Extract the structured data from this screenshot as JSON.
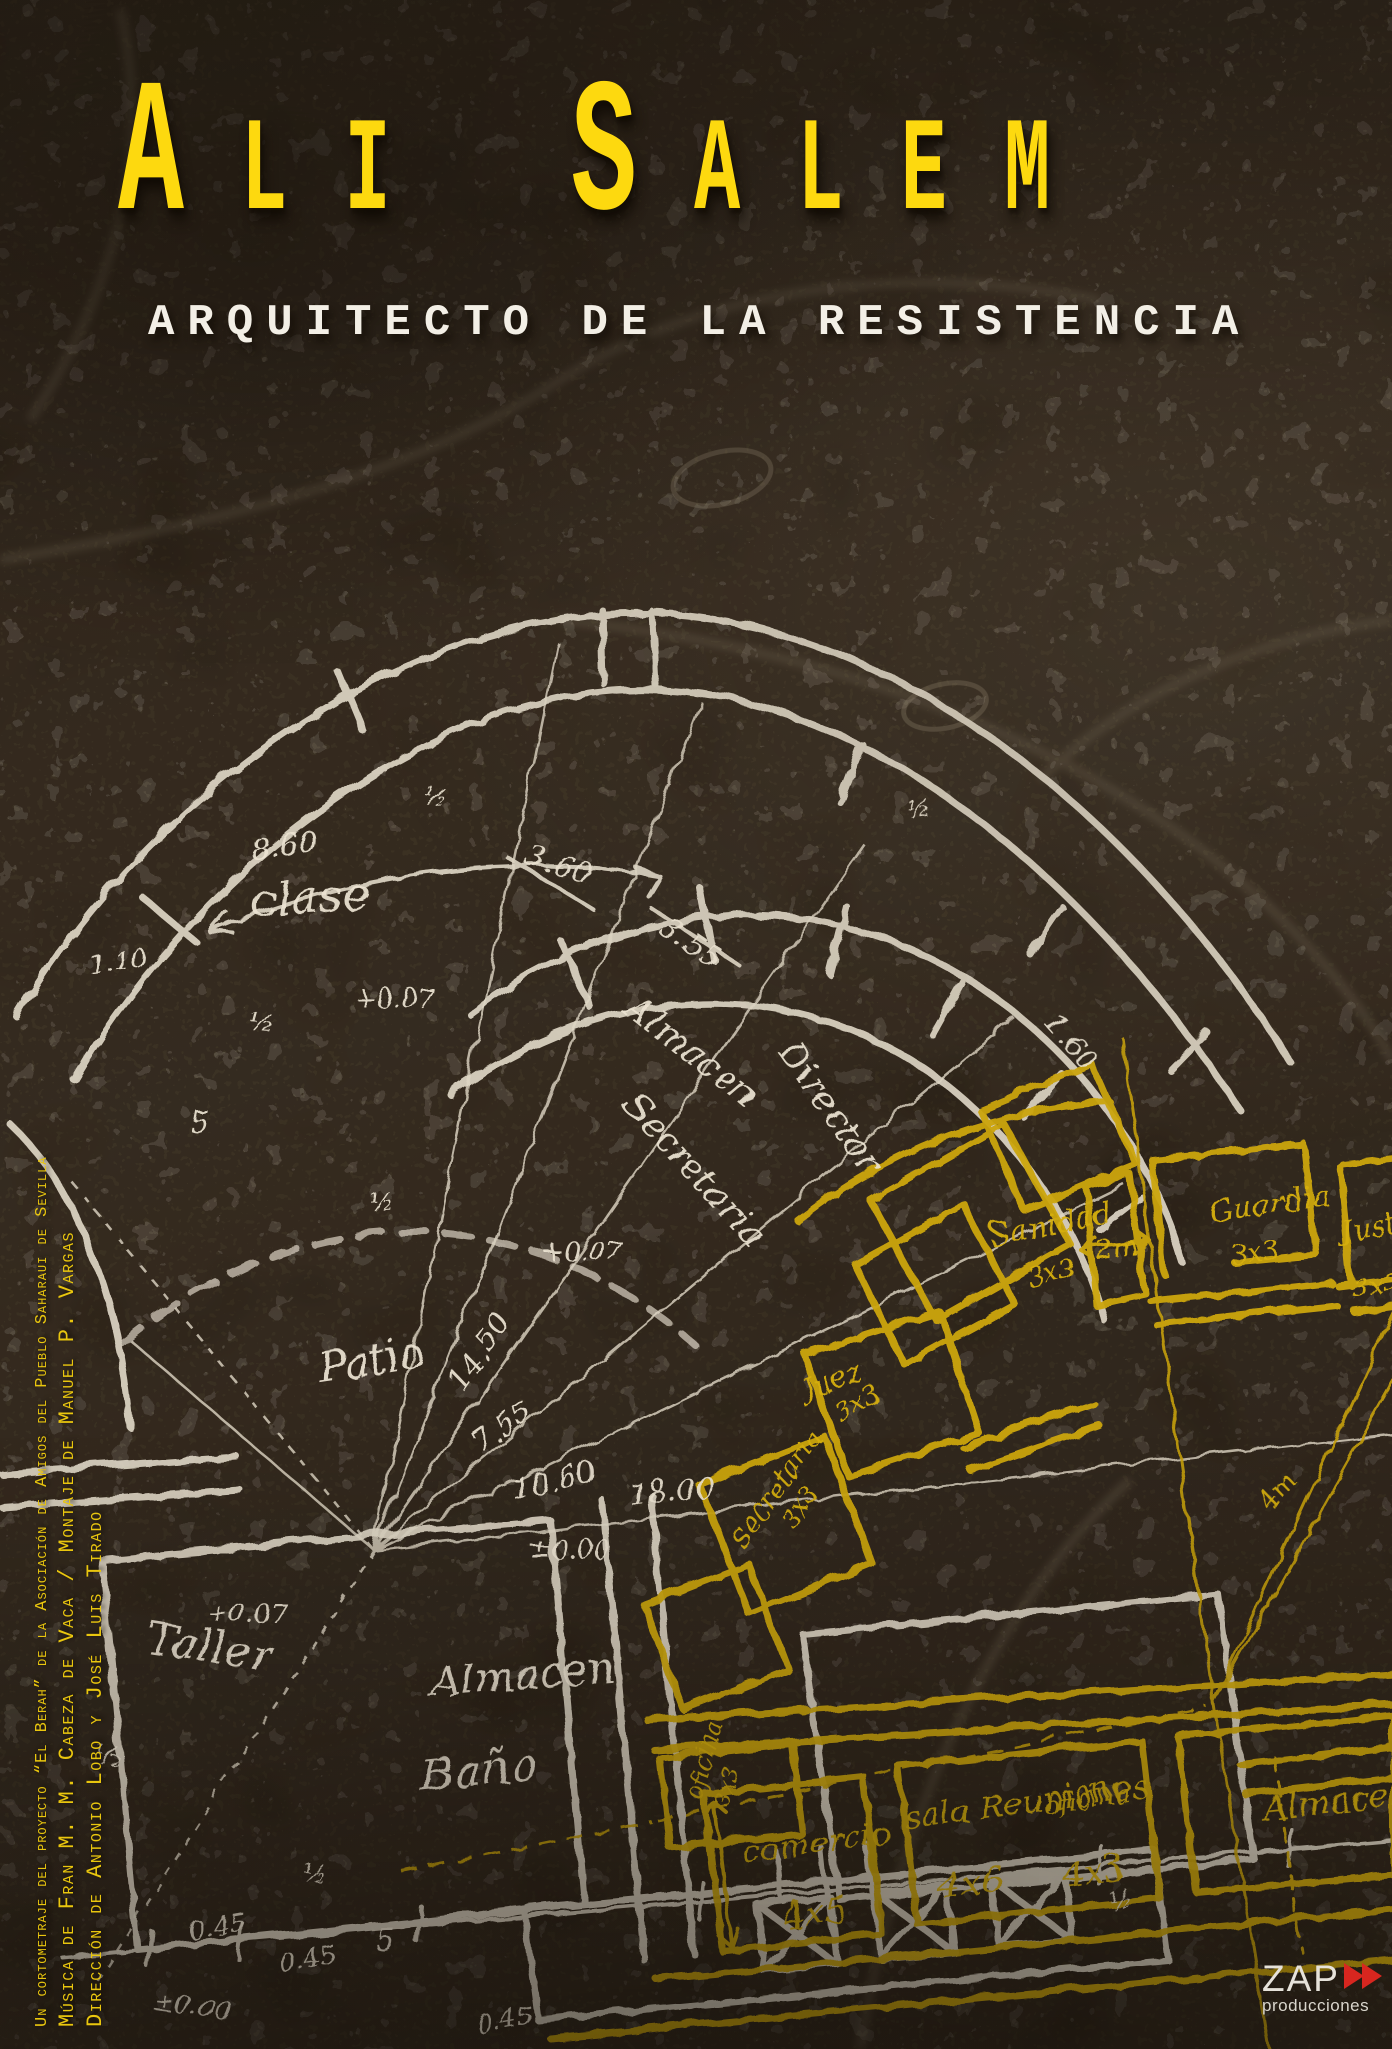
{
  "poster": {
    "title": "Ali Salem",
    "subtitle": "ARQUITECTO DE LA RESISTENCIA",
    "credits": {
      "line1": "Un cortometraje del proyecto “El Berah” de la Asociación de Amigos del Pueblo Saharaui de Sevilla",
      "line2": "Música de Fran M. M. Cabeza de Vaca / Montaje de Manuel P. Vargas",
      "line3": "Dirección de Antonio Lobo y José Luis Tirado"
    },
    "logo": {
      "name": "ZAP",
      "tagline": "producciones"
    },
    "colors": {
      "title_yellow": "#fdd90f",
      "plan_yellow": "#cda60f",
      "plan_white": "#e6decd",
      "logo_red": "#d8261f",
      "background_brown": "#453c30"
    }
  },
  "plan": {
    "white": {
      "rooms": [
        "clase",
        "Almacen",
        "Director",
        "Secretaria",
        "Patio",
        "Taller",
        "Almacen",
        "Baño"
      ],
      "measures": [
        "8.60",
        "3.60",
        "3.55",
        "1.60",
        "14.50",
        "7.55",
        "10.60",
        "18.00",
        "+0.07",
        "±0.00",
        "0.45",
        "5",
        "½",
        "1.10"
      ]
    },
    "yellow": {
      "rooms": [
        "Sanidad",
        "Guardia",
        "Justicia",
        "Juez",
        "Secretaria",
        "oficina",
        "comercio",
        "sala Reuniones",
        "oficina",
        "Almacen"
      ],
      "measures": [
        "3x3",
        "2m",
        "4m",
        "4x5",
        "4x6",
        "4x3"
      ]
    }
  }
}
